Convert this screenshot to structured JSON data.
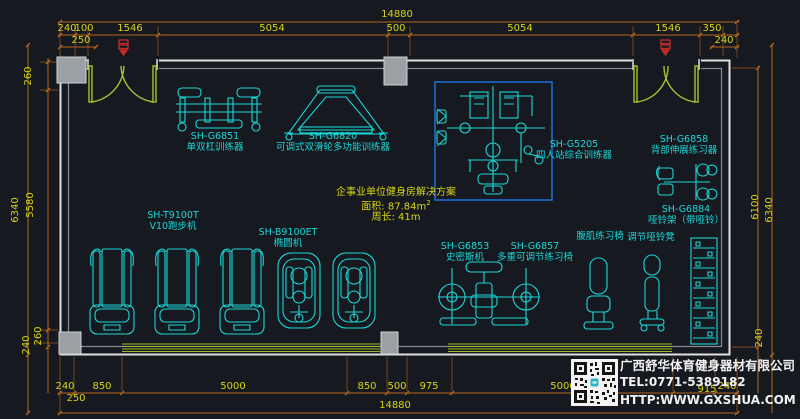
{
  "dims": {
    "overall_top": "14880",
    "overall_bottom": "14880",
    "top": [
      "240",
      "100",
      "1546",
      "5054",
      "500",
      "5054",
      "1546",
      "350"
    ],
    "top_sub_left": "250",
    "top_sub_right": "240",
    "left": [
      "260",
      "6340",
      "5580",
      "260",
      "240"
    ],
    "right": [
      "6100",
      "6340",
      "240"
    ],
    "bottom": [
      "240",
      "850",
      "5000",
      "850",
      "500",
      "975",
      "5000",
      "915",
      "240"
    ],
    "bottom_sub_left": "250"
  },
  "equipment": {
    "g6851": {
      "model": "SH-G6851",
      "name": "单双杠训练器"
    },
    "g6820": {
      "model": "SH-G6820",
      "name": "可调式双滑轮多功能训练器"
    },
    "g5205": {
      "model": "SH-G5205",
      "name": "四人站综合训练器"
    },
    "g6858": {
      "model": "SH-G6858",
      "name": "背部伸展练习器"
    },
    "g6884": {
      "model": "SH-G6884",
      "name": "哑铃架（带哑铃）"
    },
    "t9100t": {
      "model": "SH-T9100T",
      "name": "V10跑步机"
    },
    "b9100et": {
      "model": "SH-B9100ET",
      "name": "椭圆机"
    },
    "g6853": {
      "model": "SH-G6853",
      "name": "史密斯机"
    },
    "g6857": {
      "model": "SH-G6857",
      "name": "多重可调节练习椅"
    },
    "ab_chair": {
      "name": "腹肌练习椅"
    },
    "dumbbell_bench": {
      "name": "调节哑铃凳"
    }
  },
  "info": {
    "title": "企事业单位健身房解决方案",
    "area": "面积: 87.84m",
    "area_sup": "2",
    "perimeter": "周长: 41m"
  },
  "company": {
    "name": "广西舒华体育健身器材有限公司",
    "tel": "TEL:0771-5389182",
    "web": "HTTP:WWW.GXSHUA.COM"
  },
  "colors": {
    "background": "#161a20",
    "equipment_cyan": "#1bd6d6",
    "dimension_orange": "#b4661c",
    "dimension_text_yellow": "#d8d414",
    "wall_white": "#e0e0e0",
    "door_green": "#a6c230",
    "selection_blue": "#1f6fe0",
    "door_tag_red": "#c42a2a"
  }
}
